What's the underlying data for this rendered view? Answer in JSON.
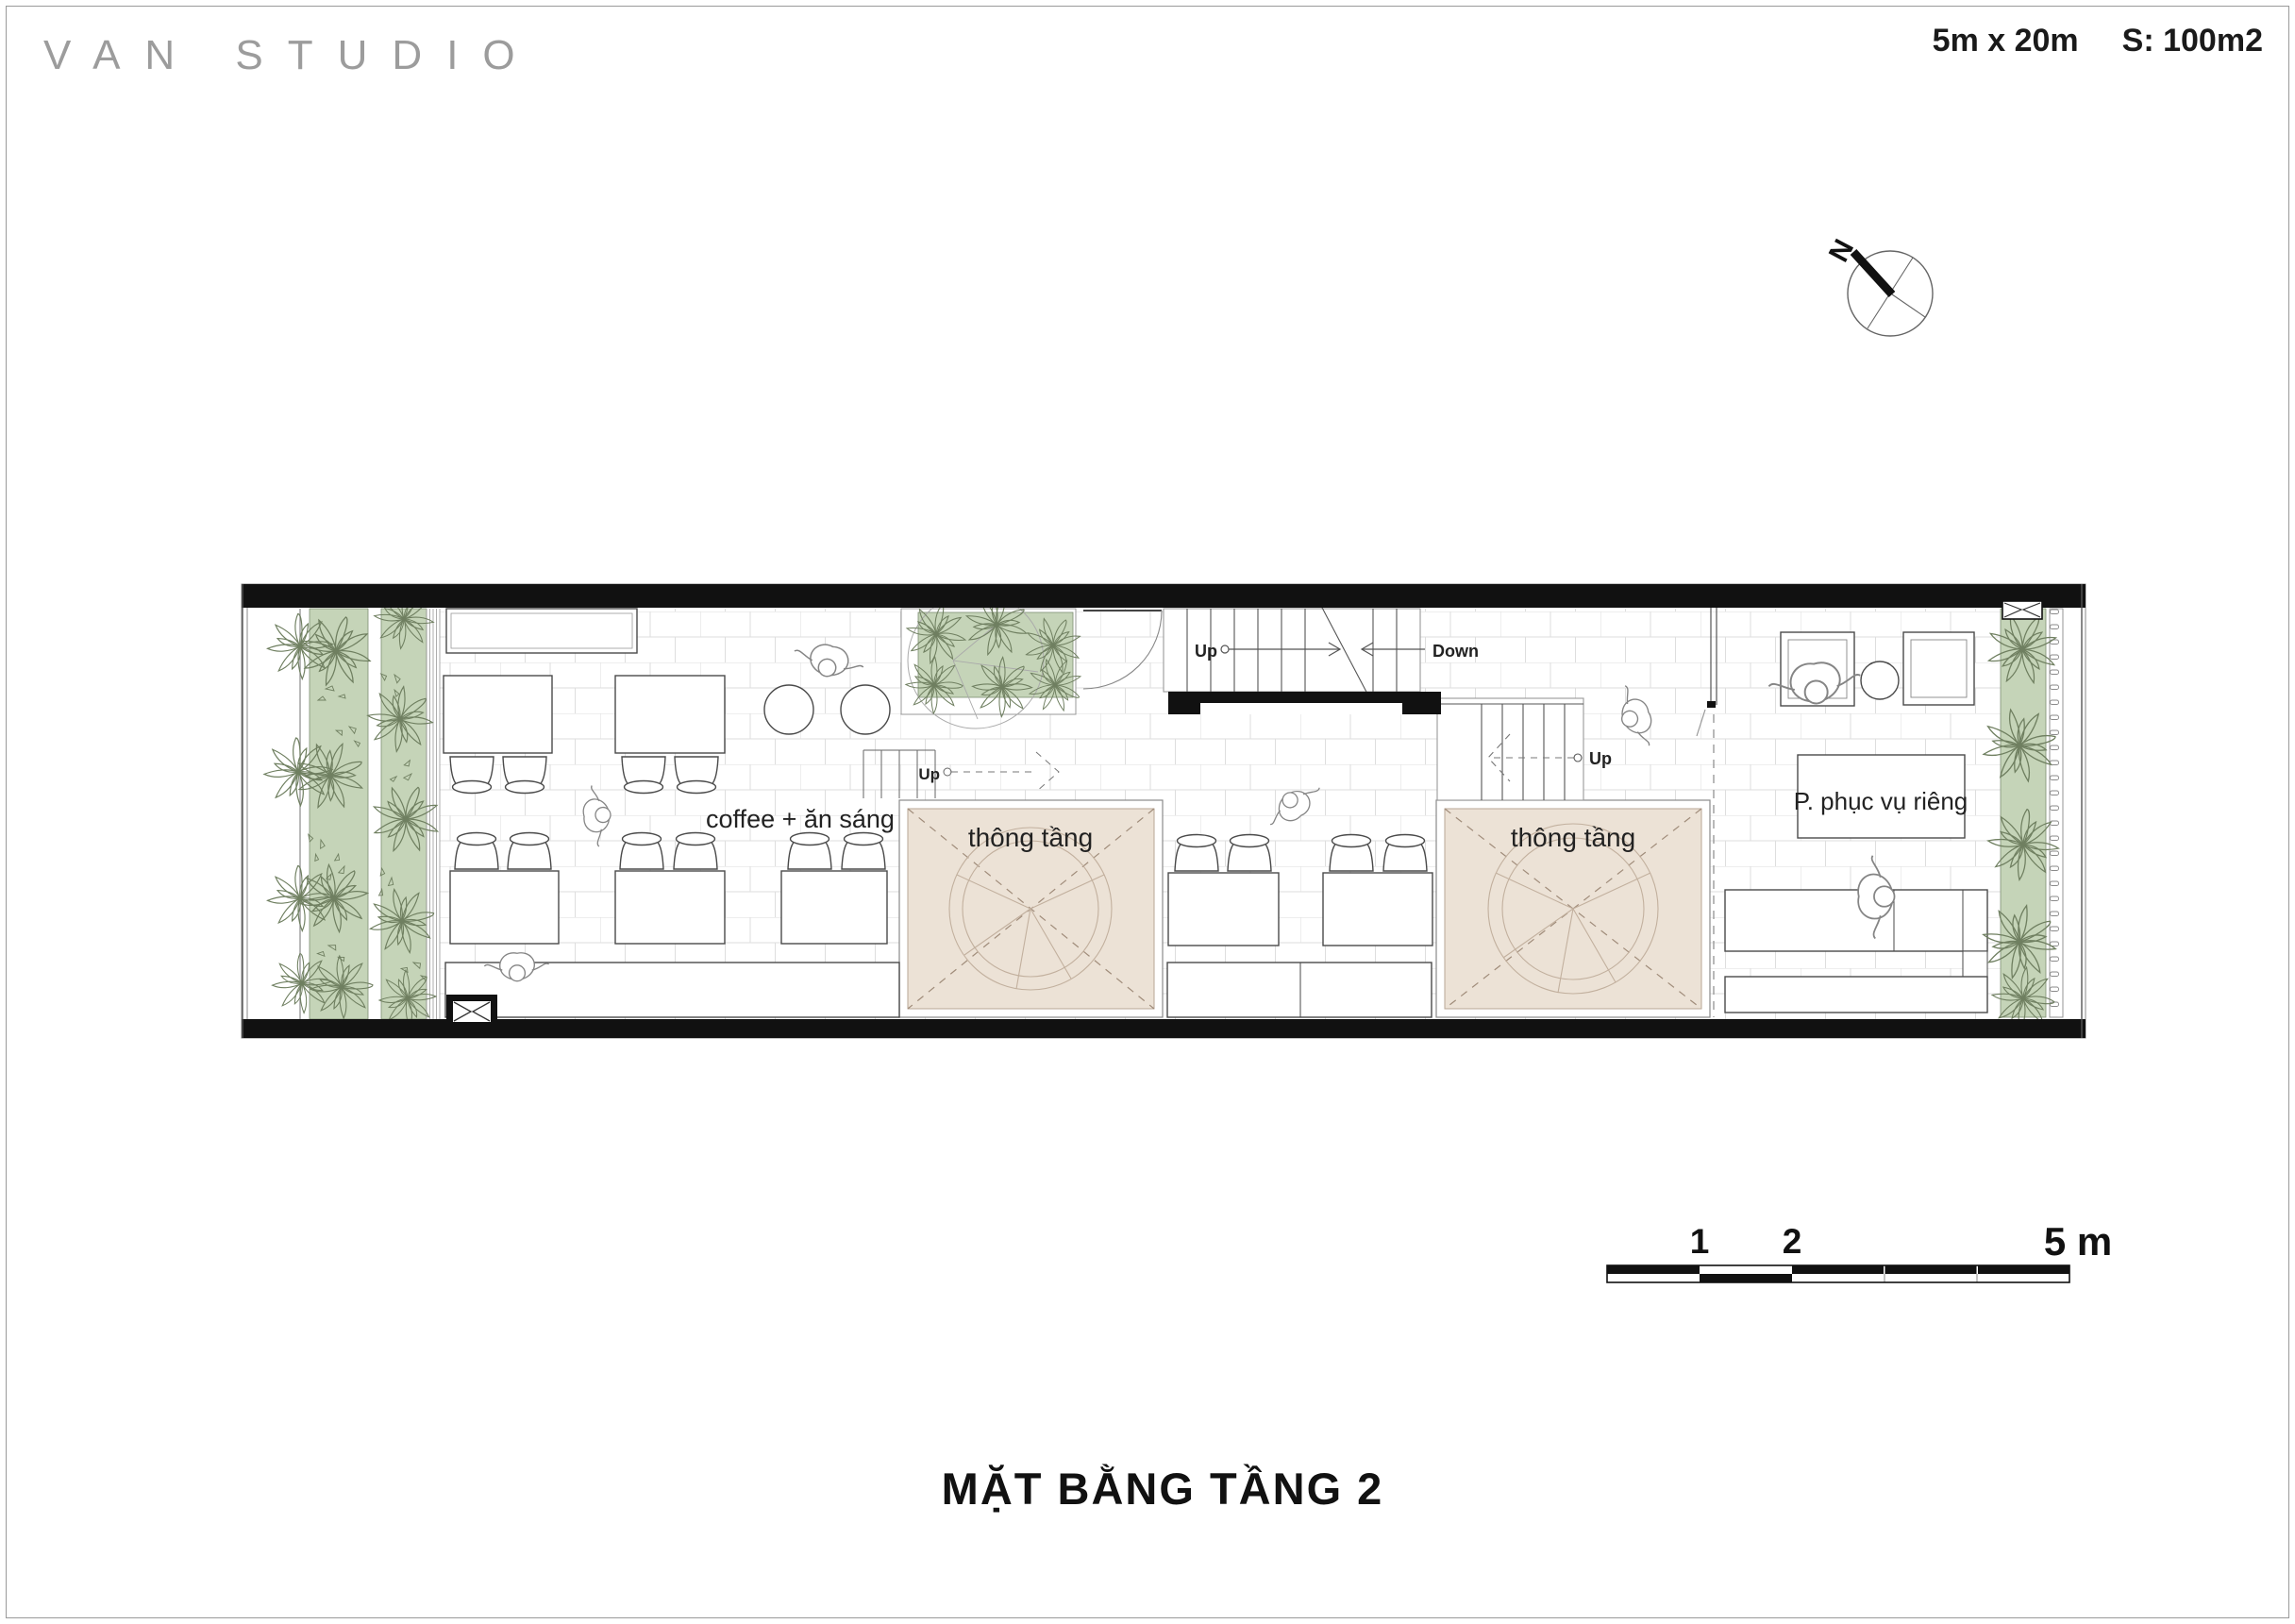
{
  "header": {
    "studio": "VAN STUDIO",
    "dimensions": "5m x 20m",
    "area": "S: 100m2"
  },
  "plan": {
    "room_labels": {
      "cafe": "coffee + ăn sáng",
      "void_left": "thông tầng",
      "void_right": "thông tầng",
      "private_room": "P. phục vụ riêng"
    },
    "stairs": {
      "main_up": "Up",
      "main_down": "Down",
      "left_up": "Up",
      "right_up": "Up"
    },
    "compass_north": "N"
  },
  "scale_bar": {
    "labels": [
      "1",
      "2",
      "5 m"
    ]
  },
  "footer": {
    "title": "MẶT BẰNG TẦNG 2"
  },
  "colors": {
    "planting_green": "#c5d4b8",
    "void_beige": "#ece2d6",
    "wall_black": "#111111"
  }
}
